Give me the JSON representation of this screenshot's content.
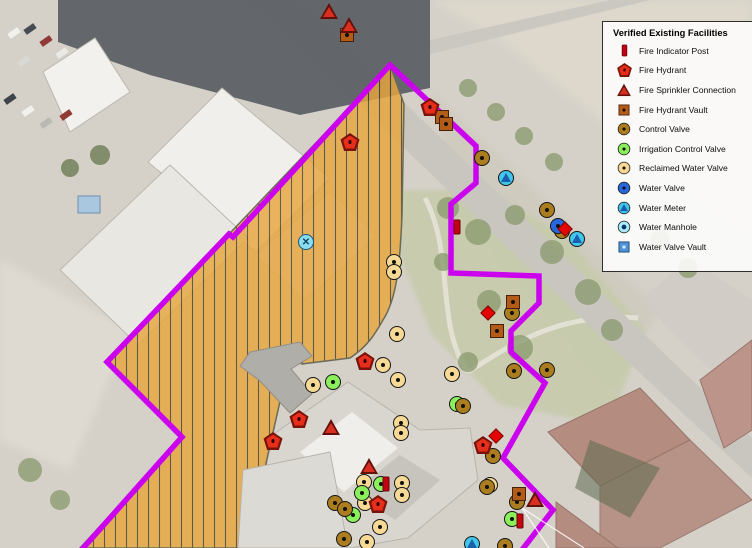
{
  "legend": {
    "title": "Verified Existing Facilities",
    "items": [
      {
        "type": "fire-indicator-post",
        "label": "Fire Indicator Post"
      },
      {
        "type": "fire-hydrant",
        "label": "Fire Hydrant"
      },
      {
        "type": "fire-sprinkler-connection",
        "label": "Fire Sprinkler Connection"
      },
      {
        "type": "fire-hydrant-vault",
        "label": "Fire Hydrant Vault"
      },
      {
        "type": "control-valve",
        "label": "Control Valve"
      },
      {
        "type": "irrigation-control-valve",
        "label": "Irrigation Control Valve"
      },
      {
        "type": "reclaimed-water-valve",
        "label": "Reclaimed Water Valve"
      },
      {
        "type": "water-valve",
        "label": "Water Valve"
      },
      {
        "type": "water-meter",
        "label": "Water Meter"
      },
      {
        "type": "water-manhole",
        "label": "Water Manhole"
      },
      {
        "type": "water-valve-vault",
        "label": "Water Valve Vault"
      }
    ]
  },
  "map": {
    "colors": {
      "boundary": "#cb02ee",
      "hatch_fill": "#e7a63e",
      "hatch_line": "#44402e",
      "legend_border": "#2e2e2e"
    },
    "markers": [
      {
        "type": "reclaimed-water-valve",
        "x": 394,
        "y": 262
      },
      {
        "type": "reclaimed-water-valve",
        "x": 394,
        "y": 272
      },
      {
        "type": "reclaimed-water-valve",
        "x": 397,
        "y": 334
      },
      {
        "type": "reclaimed-water-valve",
        "x": 383,
        "y": 365
      },
      {
        "type": "reclaimed-water-valve",
        "x": 452,
        "y": 374
      },
      {
        "type": "reclaimed-water-valve",
        "x": 398,
        "y": 380
      },
      {
        "type": "reclaimed-water-valve",
        "x": 313,
        "y": 385
      },
      {
        "type": "reclaimed-water-valve",
        "x": 401,
        "y": 423
      },
      {
        "type": "reclaimed-water-valve",
        "x": 401,
        "y": 433
      },
      {
        "type": "reclaimed-water-valve",
        "x": 364,
        "y": 482
      },
      {
        "type": "reclaimed-water-valve",
        "x": 402,
        "y": 483
      },
      {
        "type": "reclaimed-water-valve",
        "x": 402,
        "y": 495
      },
      {
        "type": "reclaimed-water-valve",
        "x": 365,
        "y": 503
      },
      {
        "type": "reclaimed-water-valve",
        "x": 380,
        "y": 527
      },
      {
        "type": "reclaimed-water-valve",
        "x": 367,
        "y": 542
      },
      {
        "type": "reclaimed-water-valve",
        "x": 490,
        "y": 485
      },
      {
        "type": "irrigation-control-valve",
        "x": 333,
        "y": 382
      },
      {
        "type": "irrigation-control-valve",
        "x": 457,
        "y": 404
      },
      {
        "type": "irrigation-control-valve",
        "x": 362,
        "y": 493
      },
      {
        "type": "irrigation-control-valve",
        "x": 381,
        "y": 484
      },
      {
        "type": "irrigation-control-valve",
        "x": 353,
        "y": 515
      },
      {
        "type": "irrigation-control-valve",
        "x": 512,
        "y": 519
      },
      {
        "type": "control-valve",
        "x": 482,
        "y": 158
      },
      {
        "type": "control-valve",
        "x": 547,
        "y": 210
      },
      {
        "type": "control-valve",
        "x": 562,
        "y": 231
      },
      {
        "type": "control-valve",
        "x": 512,
        "y": 313
      },
      {
        "type": "control-valve",
        "x": 514,
        "y": 371
      },
      {
        "type": "control-valve",
        "x": 547,
        "y": 370
      },
      {
        "type": "control-valve",
        "x": 463,
        "y": 406
      },
      {
        "type": "control-valve",
        "x": 493,
        "y": 456
      },
      {
        "type": "control-valve",
        "x": 487,
        "y": 487
      },
      {
        "type": "control-valve",
        "x": 517,
        "y": 502
      },
      {
        "type": "control-valve",
        "x": 335,
        "y": 503
      },
      {
        "type": "control-valve",
        "x": 345,
        "y": 509
      },
      {
        "type": "control-valve",
        "x": 344,
        "y": 539
      },
      {
        "type": "control-valve",
        "x": 505,
        "y": 546
      },
      {
        "type": "water-valve",
        "x": 558,
        "y": 226
      },
      {
        "type": "water-meter",
        "x": 506,
        "y": 178
      },
      {
        "type": "water-meter",
        "x": 577,
        "y": 239
      },
      {
        "type": "water-meter",
        "x": 472,
        "y": 544
      },
      {
        "type": "water-valve-x",
        "x": 306,
        "y": 242
      },
      {
        "type": "fire-hydrant-vault",
        "x": 347,
        "y": 35
      },
      {
        "type": "fire-hydrant-vault",
        "x": 442,
        "y": 117
      },
      {
        "type": "fire-hydrant-vault",
        "x": 446,
        "y": 124
      },
      {
        "type": "fire-hydrant-vault",
        "x": 513,
        "y": 302
      },
      {
        "type": "fire-hydrant-vault",
        "x": 497,
        "y": 331
      },
      {
        "type": "fire-hydrant-vault",
        "x": 519,
        "y": 494
      },
      {
        "type": "fire-indicator-post",
        "x": 457,
        "y": 227
      },
      {
        "type": "fire-indicator-post",
        "x": 386,
        "y": 484
      },
      {
        "type": "fire-indicator-post",
        "x": 520,
        "y": 521
      },
      {
        "type": "fire-hydrant",
        "x": 430,
        "y": 107
      },
      {
        "type": "fire-hydrant",
        "x": 350,
        "y": 142
      },
      {
        "type": "fire-hydrant",
        "x": 365,
        "y": 361
      },
      {
        "type": "fire-hydrant",
        "x": 299,
        "y": 419
      },
      {
        "type": "fire-hydrant",
        "x": 273,
        "y": 441
      },
      {
        "type": "fire-hydrant",
        "x": 483,
        "y": 445
      },
      {
        "type": "fire-hydrant",
        "x": 378,
        "y": 504
      },
      {
        "type": "fire-sprinkler-connection",
        "x": 329,
        "y": 11
      },
      {
        "type": "fire-sprinkler-connection",
        "x": 349,
        "y": 25
      },
      {
        "type": "fire-sprinkler-connection",
        "x": 331,
        "y": 427
      },
      {
        "type": "fire-sprinkler-connection",
        "x": 369,
        "y": 466
      },
      {
        "type": "fire-sprinkler-connection",
        "x": 535,
        "y": 499
      },
      {
        "type": "fire-diamond",
        "x": 565,
        "y": 229
      },
      {
        "type": "fire-diamond",
        "x": 488,
        "y": 313
      },
      {
        "type": "fire-diamond",
        "x": 496,
        "y": 436
      }
    ]
  }
}
